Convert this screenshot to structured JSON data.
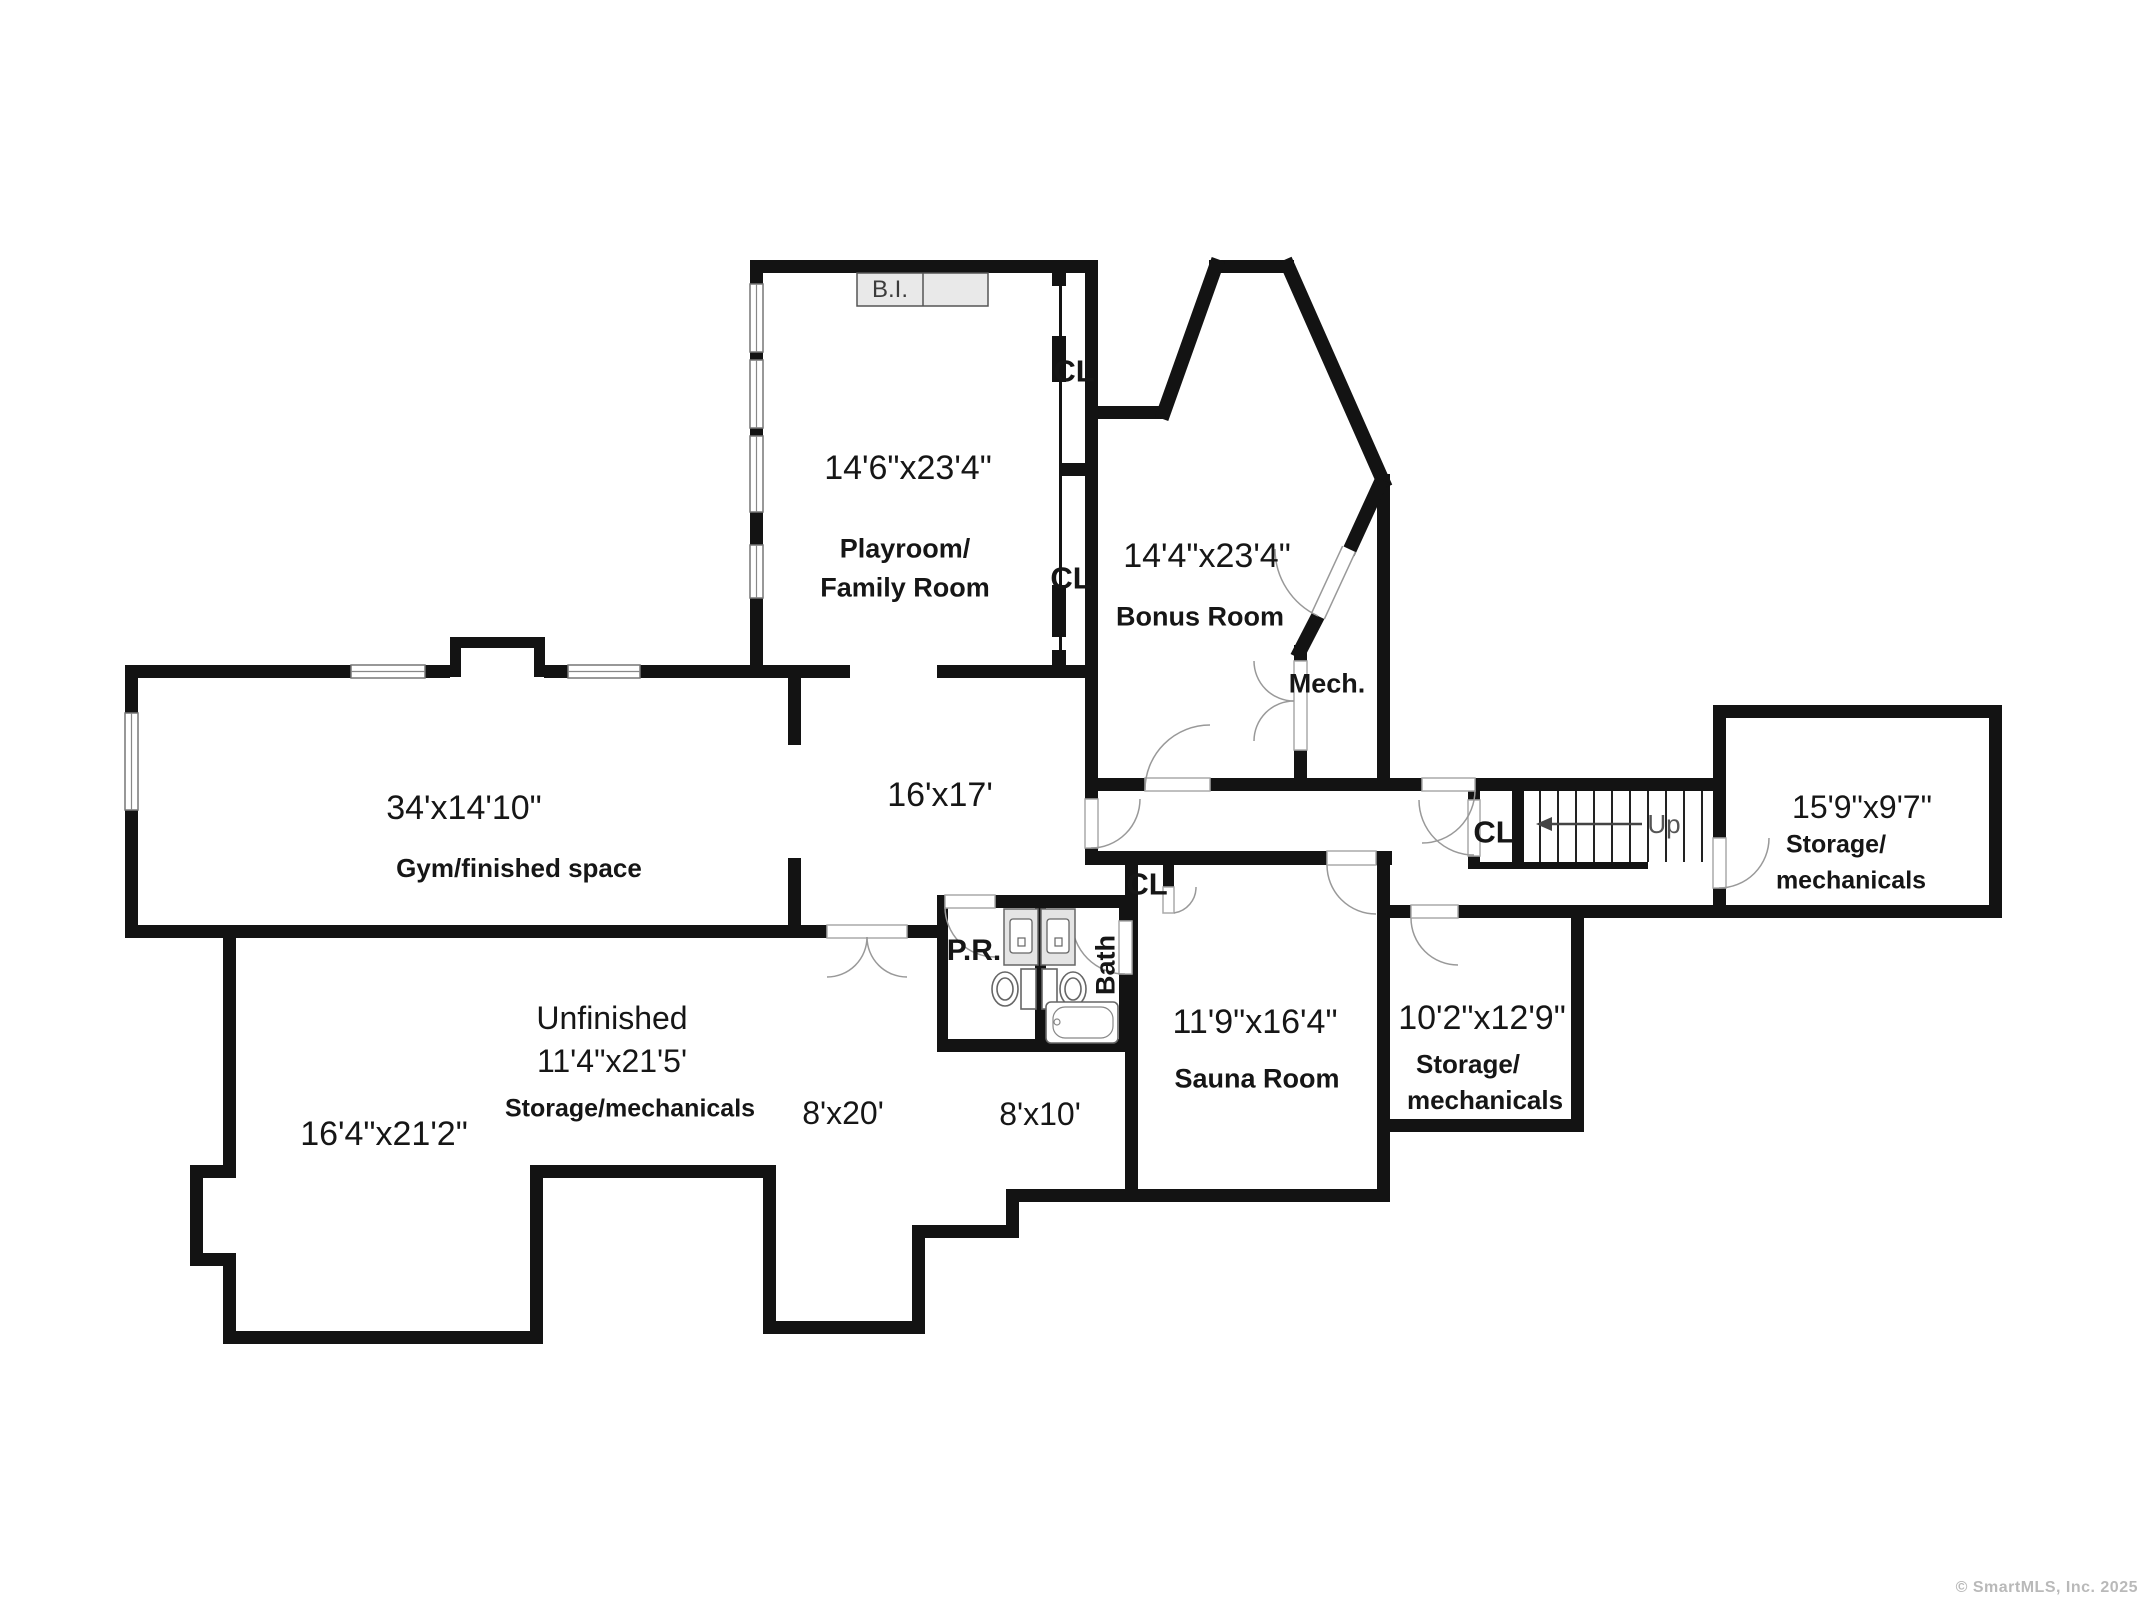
{
  "watermark": "© SmartMLS, Inc.  2025",
  "labels": {
    "built_in": "B.I.",
    "closet": "CL",
    "mechanical_closet": "Mech.",
    "stairs_up": "Up",
    "powder_room": "P.R.",
    "bathroom": "Bath"
  },
  "rooms": {
    "playroom": {
      "dimensions": "14'6\"x23'4\"",
      "name_line1": "Playroom/",
      "name_line2": "Family Room"
    },
    "bonus_room": {
      "dimensions": "14'4\"x23'4\"",
      "name": "Bonus Room"
    },
    "gym": {
      "dimensions": "34'x14'10\"",
      "name": "Gym/finished space"
    },
    "rec_room": {
      "dimensions": "16'x17'"
    },
    "storage_right": {
      "dimensions": "15'9\"x9'7\"",
      "name_line1": "Storage/",
      "name_line2": "mechanicals"
    },
    "unfinished": {
      "name_line1": "Unfinished",
      "dimensions": "11'4\"x21'5'",
      "name_line2": "Storage/mechanicals"
    },
    "unfinished_left": {
      "dimensions": "16'4\"x21'2\""
    },
    "area_8x20": {
      "dimensions": "8'x20'"
    },
    "area_8x10": {
      "dimensions": "8'x10'"
    },
    "sauna": {
      "dimensions": "11'9\"x16'4\"",
      "name": "Sauna Room"
    },
    "storage_mid": {
      "dimensions": "10'2\"x12'9\"",
      "name_line1": "Storage/",
      "name_line2": "mechanicals"
    }
  }
}
